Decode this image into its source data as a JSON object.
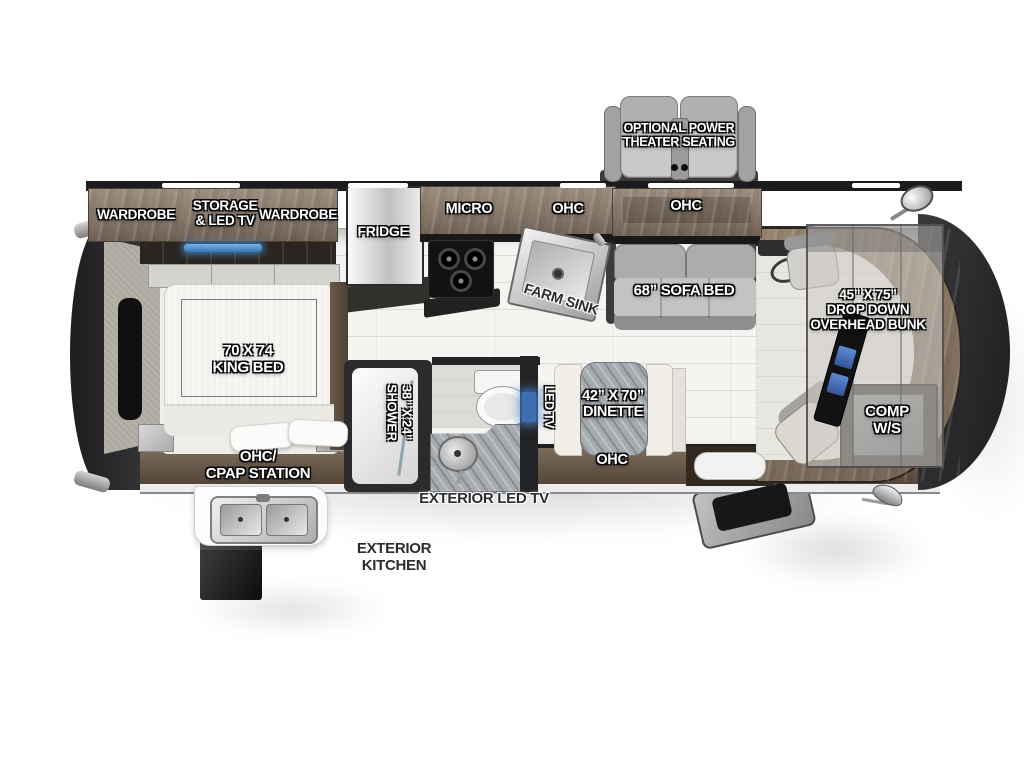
{
  "diagram": {
    "type": "rv-motorhome-floorplan",
    "orientation": "rear-left-front-right"
  },
  "labels": {
    "theater_seating": "OPTIONAL POWER\nTHEATER SEATING",
    "wardrobe_left": "WARDROBE",
    "storage_led_tv": "STORAGE\n& LED TV",
    "wardrobe_right": "WARDROBE",
    "fridge": "FRIDGE",
    "micro": "MICRO",
    "kitchen_ohc": "OHC",
    "farm_sink": "FARM SINK",
    "sofa_ohc": "OHC",
    "sofa_bed": "68” SOFA BED",
    "overhead_bunk": "45” X 75”\nDROP DOWN\nOVERHEAD BUNK",
    "king_bed": "70 X 74\nKING BED",
    "ohc_cpap": "OHC/\nCPAP STATION",
    "shower": "38” X 24”\nSHOWER",
    "led_tv": "LED TV",
    "dinette": "42” X 70”\nDINETTE",
    "dinette_ohc": "OHC",
    "comp_ws": "COMP\nW/S",
    "exterior_led_tv": "EXTERIOR LED TV",
    "exterior_kitchen": "EXTERIOR\nKITCHEN"
  },
  "colors": {
    "trim_dark": "#262628",
    "wood_upper": "#8d7f72",
    "wood_lower": "#6e5e4e",
    "stainless": "#c9c9c9",
    "seat_gray": "#bcbcbe",
    "led_blue": "#4a8fd4",
    "tile_floor": "#f5f4f1",
    "granite": "#a6abaf"
  }
}
